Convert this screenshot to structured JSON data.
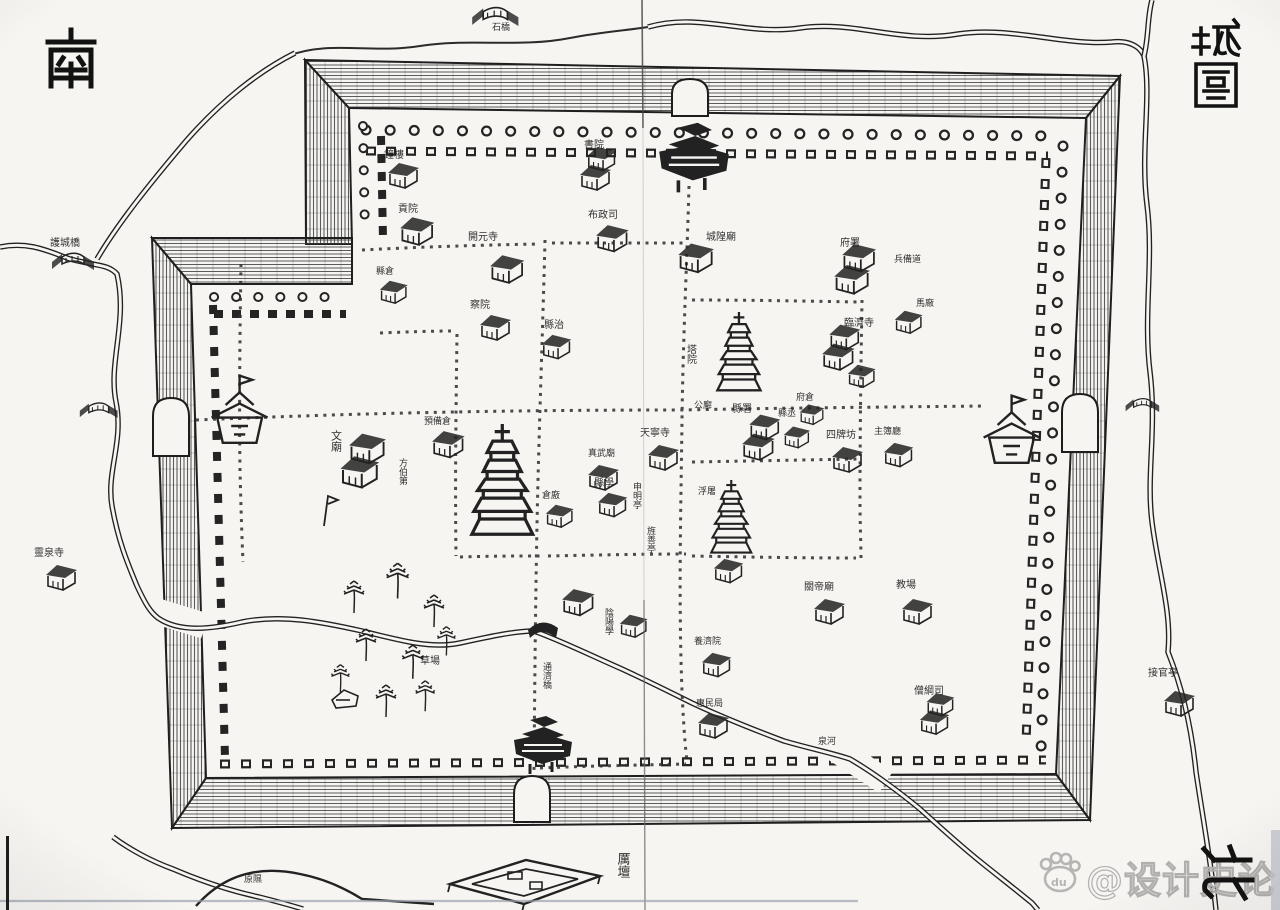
{
  "compass": {
    "south": "南",
    "north": "北"
  },
  "title": {
    "text": "城圖"
  },
  "watermark": {
    "text": "@设计史论",
    "paw_text": "du"
  },
  "map": {
    "ink": "#262626",
    "labels": [
      {
        "t": "護城橋",
        "x": 50,
        "y": 246,
        "s": 10
      },
      {
        "t": "石橋",
        "x": 492,
        "y": 30,
        "s": 9
      },
      {
        "t": "靈泉寺",
        "x": 34,
        "y": 556,
        "s": 10
      },
      {
        "t": "接官亭",
        "x": 1148,
        "y": 676,
        "s": 10
      },
      {
        "t": "厲壇",
        "x": 622,
        "y": 852,
        "s": 13,
        "v": true
      },
      {
        "t": "原隰",
        "x": 244,
        "y": 882,
        "s": 9
      },
      {
        "t": "泉河",
        "x": 818,
        "y": 744,
        "s": 9
      },
      {
        "t": "鐘樓",
        "x": 384,
        "y": 158,
        "s": 10
      },
      {
        "t": "貢院",
        "x": 398,
        "y": 212,
        "s": 10
      },
      {
        "t": "縣倉",
        "x": 376,
        "y": 274,
        "s": 9
      },
      {
        "t": "開元寺",
        "x": 468,
        "y": 240,
        "s": 10
      },
      {
        "t": "察院",
        "x": 470,
        "y": 308,
        "s": 10
      },
      {
        "t": "縣治",
        "x": 544,
        "y": 328,
        "s": 10
      },
      {
        "t": "書院",
        "x": 584,
        "y": 148,
        "s": 10
      },
      {
        "t": "布政司",
        "x": 588,
        "y": 218,
        "s": 10
      },
      {
        "t": "城隍廟",
        "x": 706,
        "y": 240,
        "s": 10
      },
      {
        "t": "府署",
        "x": 840,
        "y": 246,
        "s": 10
      },
      {
        "t": "兵備道",
        "x": 894,
        "y": 262,
        "s": 9
      },
      {
        "t": "臨濟寺",
        "x": 844,
        "y": 326,
        "s": 10
      },
      {
        "t": "馬廠",
        "x": 916,
        "y": 306,
        "s": 9
      },
      {
        "t": "塔院",
        "x": 690,
        "y": 344,
        "s": 10,
        "v": true
      },
      {
        "t": "府倉",
        "x": 796,
        "y": 400,
        "s": 9
      },
      {
        "t": "公廨",
        "x": 694,
        "y": 408,
        "s": 9
      },
      {
        "t": "縣署",
        "x": 732,
        "y": 412,
        "s": 10
      },
      {
        "t": "縣丞",
        "x": 778,
        "y": 416,
        "s": 9
      },
      {
        "t": "四牌坊",
        "x": 826,
        "y": 438,
        "s": 10
      },
      {
        "t": "主簿廳",
        "x": 874,
        "y": 434,
        "s": 9
      },
      {
        "t": "天寧寺",
        "x": 640,
        "y": 436,
        "s": 10
      },
      {
        "t": "真武廟",
        "x": 588,
        "y": 456,
        "s": 9
      },
      {
        "t": "預備倉",
        "x": 424,
        "y": 424,
        "s": 9
      },
      {
        "t": "文廟",
        "x": 336,
        "y": 430,
        "s": 11,
        "v": true
      },
      {
        "t": "方伯第",
        "x": 402,
        "y": 458,
        "s": 9,
        "v": true
      },
      {
        "t": "倉廒",
        "x": 542,
        "y": 498,
        "s": 9
      },
      {
        "t": "縣學",
        "x": 594,
        "y": 486,
        "s": 10
      },
      {
        "t": "申明亭",
        "x": 636,
        "y": 482,
        "s": 9,
        "v": true
      },
      {
        "t": "旌善亭",
        "x": 650,
        "y": 526,
        "s": 9,
        "v": true
      },
      {
        "t": "浮屠",
        "x": 698,
        "y": 494,
        "s": 9
      },
      {
        "t": "關帝廟",
        "x": 804,
        "y": 590,
        "s": 10
      },
      {
        "t": "教場",
        "x": 896,
        "y": 588,
        "s": 10
      },
      {
        "t": "陰陽學",
        "x": 608,
        "y": 608,
        "s": 9,
        "v": true
      },
      {
        "t": "養濟院",
        "x": 694,
        "y": 644,
        "s": 9
      },
      {
        "t": "惠民局",
        "x": 696,
        "y": 706,
        "s": 9
      },
      {
        "t": "僧綱司",
        "x": 914,
        "y": 694,
        "s": 10
      },
      {
        "t": "通濟橋",
        "x": 546,
        "y": 662,
        "s": 9,
        "v": true
      },
      {
        "t": "草場",
        "x": 420,
        "y": 664,
        "s": 10
      }
    ],
    "features": [
      {
        "k": "gatetower",
        "x": 652,
        "y": 118,
        "s": 1.2
      },
      {
        "k": "gatetower",
        "x": 508,
        "y": 712,
        "s": 1.0
      },
      {
        "k": "tower",
        "x": 206,
        "y": 370,
        "s": 1.4
      },
      {
        "k": "tower",
        "x": 978,
        "y": 390,
        "s": 1.4
      },
      {
        "k": "pagoda",
        "x": 470,
        "y": 424,
        "s": 1.9
      },
      {
        "k": "pagoda",
        "x": 716,
        "y": 312,
        "s": 1.35
      },
      {
        "k": "pagoda",
        "x": 710,
        "y": 480,
        "s": 1.25
      },
      {
        "k": "house",
        "x": 386,
        "y": 160,
        "s": 1
      },
      {
        "k": "house",
        "x": 398,
        "y": 214,
        "s": 1.1
      },
      {
        "k": "house",
        "x": 378,
        "y": 278,
        "s": 0.9
      },
      {
        "k": "house",
        "x": 488,
        "y": 252,
        "s": 1.1
      },
      {
        "k": "house",
        "x": 478,
        "y": 312,
        "s": 1
      },
      {
        "k": "house",
        "x": 540,
        "y": 332,
        "s": 0.95
      },
      {
        "k": "bighouse",
        "x": 578,
        "y": 152,
        "s": 1
      },
      {
        "k": "house",
        "x": 594,
        "y": 222,
        "s": 1.05
      },
      {
        "k": "house",
        "x": 676,
        "y": 240,
        "s": 1.15
      },
      {
        "k": "bighouse",
        "x": 832,
        "y": 250,
        "s": 1.15
      },
      {
        "k": "bighouse",
        "x": 820,
        "y": 330,
        "s": 1.05
      },
      {
        "k": "house",
        "x": 893,
        "y": 308,
        "s": 0.9
      },
      {
        "k": "house",
        "x": 846,
        "y": 362,
        "s": 0.9
      },
      {
        "k": "house",
        "x": 798,
        "y": 402,
        "s": 0.8
      },
      {
        "k": "bighouse",
        "x": 740,
        "y": 420,
        "s": 1.05
      },
      {
        "k": "house",
        "x": 782,
        "y": 424,
        "s": 0.85
      },
      {
        "k": "house",
        "x": 830,
        "y": 444,
        "s": 1
      },
      {
        "k": "house",
        "x": 882,
        "y": 440,
        "s": 0.95
      },
      {
        "k": "house",
        "x": 646,
        "y": 442,
        "s": 1
      },
      {
        "k": "house",
        "x": 586,
        "y": 462,
        "s": 1
      },
      {
        "k": "house",
        "x": 430,
        "y": 428,
        "s": 1.05
      },
      {
        "k": "bighouse",
        "x": 338,
        "y": 440,
        "s": 1.25
      },
      {
        "k": "flagpole",
        "x": 318,
        "y": 492,
        "s": 1
      },
      {
        "k": "house",
        "x": 544,
        "y": 502,
        "s": 0.9
      },
      {
        "k": "house",
        "x": 596,
        "y": 490,
        "s": 0.95
      },
      {
        "k": "house",
        "x": 712,
        "y": 556,
        "s": 0.95
      },
      {
        "k": "house",
        "x": 812,
        "y": 596,
        "s": 1
      },
      {
        "k": "house",
        "x": 900,
        "y": 596,
        "s": 1
      },
      {
        "k": "house",
        "x": 560,
        "y": 586,
        "s": 1.05
      },
      {
        "k": "house",
        "x": 618,
        "y": 612,
        "s": 0.9
      },
      {
        "k": "house",
        "x": 700,
        "y": 650,
        "s": 0.95
      },
      {
        "k": "house",
        "x": 696,
        "y": 710,
        "s": 1
      },
      {
        "k": "bighouse",
        "x": 918,
        "y": 698,
        "s": 0.95
      },
      {
        "k": "house",
        "x": 44,
        "y": 562,
        "s": 1
      },
      {
        "k": "house",
        "x": 1162,
        "y": 688,
        "s": 1
      },
      {
        "k": "bridgeicon",
        "x": 50,
        "y": 250,
        "s": 1
      },
      {
        "k": "bridgeicon",
        "x": 78,
        "y": 400,
        "s": 0.9
      },
      {
        "k": "bridgeicon",
        "x": 1124,
        "y": 396,
        "s": 0.8
      },
      {
        "k": "bridgeicon",
        "x": 470,
        "y": 4,
        "s": 1.1
      },
      {
        "k": "bridge2",
        "x": 528,
        "y": 616,
        "s": 1
      },
      {
        "k": "altar",
        "x": 446,
        "y": 842,
        "s": 1
      },
      {
        "k": "hut",
        "x": 330,
        "y": 686,
        "s": 1
      },
      {
        "k": "tree",
        "x": 338,
        "y": 578,
        "s": 1
      },
      {
        "k": "tree",
        "x": 380,
        "y": 560,
        "s": 1.1
      },
      {
        "k": "tree",
        "x": 418,
        "y": 592,
        "s": 1
      },
      {
        "k": "tree",
        "x": 350,
        "y": 626,
        "s": 1
      },
      {
        "k": "tree",
        "x": 396,
        "y": 642,
        "s": 1.05
      },
      {
        "k": "tree",
        "x": 326,
        "y": 662,
        "s": 0.9
      },
      {
        "k": "tree",
        "x": 432,
        "y": 624,
        "s": 0.9
      },
      {
        "k": "tree",
        "x": 370,
        "y": 682,
        "s": 1
      },
      {
        "k": "tree",
        "x": 410,
        "y": 678,
        "s": 0.95
      }
    ]
  }
}
